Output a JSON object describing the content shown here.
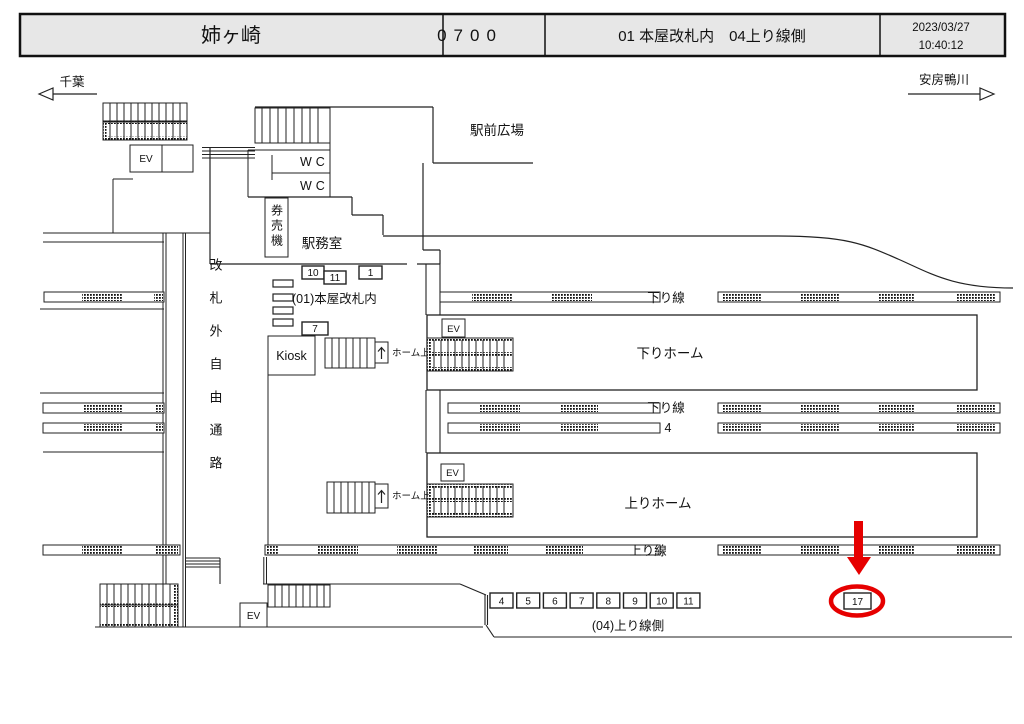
{
  "header": {
    "station_name": "姉ヶ崎",
    "code": "0700",
    "location": "01 本屋改札内　04上り線側",
    "date": "2023/03/27",
    "time": "10:40:12"
  },
  "directions": {
    "left_label": "千葉",
    "right_label": "安房鴨川"
  },
  "map": {
    "plaza": "駅前広場",
    "wc_upper": "WC",
    "wc_lower": "WC",
    "ticket_machines": "券売機",
    "station_office": "駅務室",
    "gate_area_label": "(01)本屋改札内",
    "kiosk": "Kiosk",
    "free_passage": "改札外自由通路",
    "ev": "EV",
    "platform_up_note": "ホーム上",
    "down_line_label": "下り線",
    "down_platform": "下りホーム",
    "down_line2_label": "下り線",
    "down_line2_number": "4",
    "up_platform": "上りホーム",
    "up_line_label": "上り線",
    "area_label": "(04)上り線側"
  },
  "device_boxes": {
    "building": [
      "10",
      "11",
      "1",
      "7"
    ],
    "platform_row": [
      "4",
      "5",
      "6",
      "7",
      "8",
      "9",
      "10",
      "11"
    ],
    "highlighted": "17"
  },
  "highlight": {
    "color": "#e60000",
    "target": "17"
  }
}
